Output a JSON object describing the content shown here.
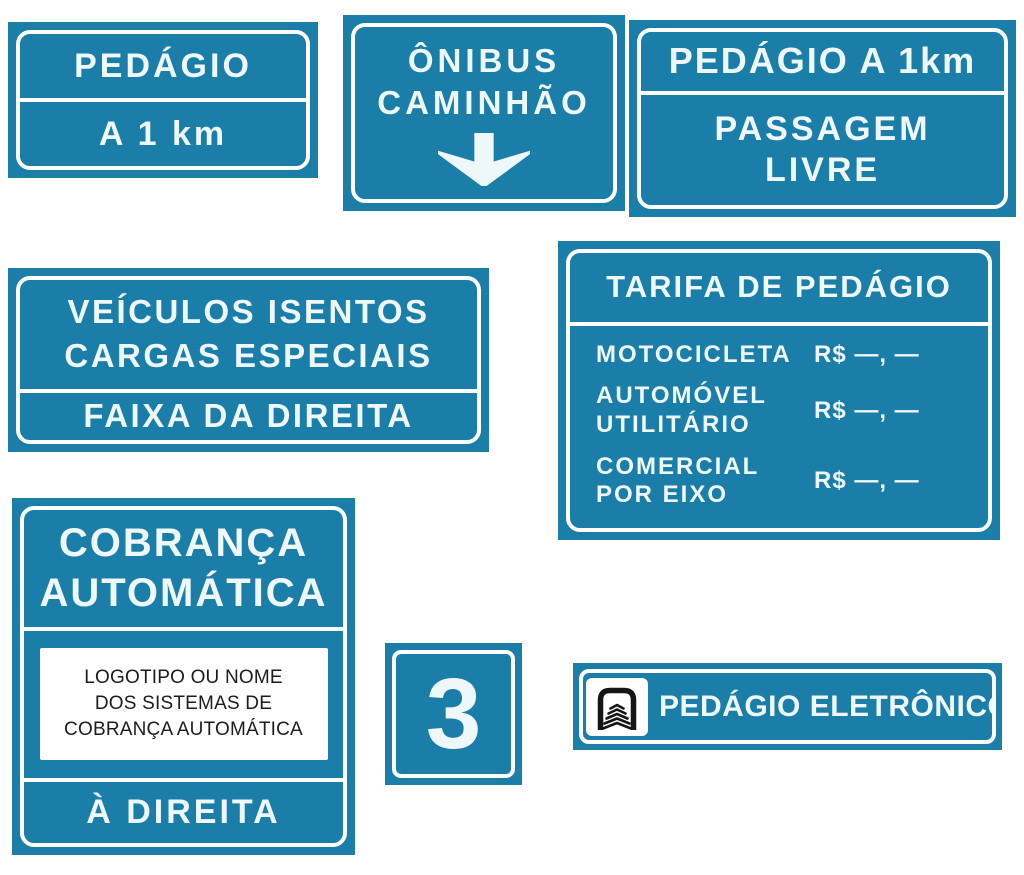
{
  "colors": {
    "sign_blue": "#1b7ea8",
    "sign_text": "#eef8fb",
    "border_white": "#ffffff",
    "logo_box_bg": "#ffffff",
    "logo_box_text": "#1c1c1c",
    "icon_black": "#151515"
  },
  "signs": {
    "pedagio_distance": {
      "top": "PEDÁGIO",
      "bottom": "A 1 km"
    },
    "onibus_caminhao": {
      "line1": "ÔNIBUS",
      "line2": "CAMINHÃO",
      "icon": "down-arrow-icon"
    },
    "pedagio_passagem": {
      "top": "PEDÁGIO A 1km",
      "bottom_line1": "PASSAGEM",
      "bottom_line2": "LIVRE"
    },
    "veiculos_isentos": {
      "line1": "VEÍCULOS ISENTOS",
      "line2": "CARGAS ESPECIAIS",
      "bottom": "FAIXA DA DIREITA"
    },
    "tarifa": {
      "title": "TARIFA DE PEDÁGIO",
      "rows": [
        {
          "label_line1": "MOTOCICLETA",
          "label_line2": "",
          "value": "R$ —, —"
        },
        {
          "label_line1": "AUTOMÓVEL",
          "label_line2": "UTILITÁRIO",
          "value": "R$ —, —"
        },
        {
          "label_line1": "COMERCIAL",
          "label_line2": "POR EIXO",
          "value": "R$ —, —"
        }
      ]
    },
    "cobranca": {
      "title_line1": "COBRANÇA",
      "title_line2": "AUTOMÁTICA",
      "box_line1": "LOGOTIPO OU NOME",
      "box_line2": "DOS SISTEMAS DE",
      "box_line3": "COBRANÇA AUTOMÁTICA",
      "bottom": "À DIREITA"
    },
    "lane_number": {
      "value": "3"
    },
    "eletronico": {
      "icon": "toll-gantry-icon",
      "label": "PEDÁGIO ELETRÔNICO"
    }
  }
}
